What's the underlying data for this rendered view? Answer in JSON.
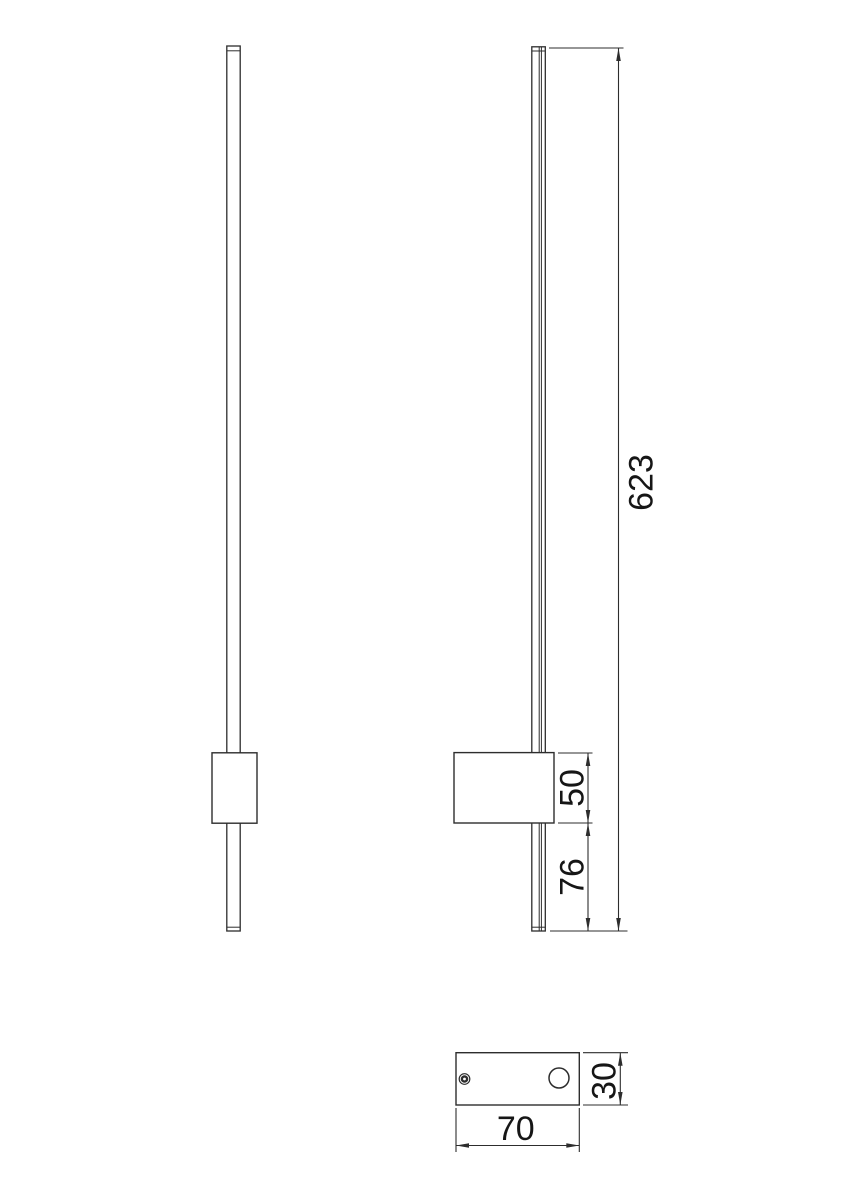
{
  "drawing": {
    "title": "wall-lamp-dimension-drawing",
    "colors": {
      "background": "#ffffff",
      "line": "#2d2d2d",
      "text": "#161616"
    },
    "views": {
      "front": "front-view",
      "side": "side-view",
      "bottom": "base-plate-top-view"
    },
    "dimensions": {
      "total_length": {
        "value": "623",
        "orientation": "vertical"
      },
      "bracket_height": {
        "value": "50",
        "orientation": "vertical"
      },
      "bottom_offset": {
        "value": "76",
        "orientation": "vertical"
      },
      "base_length": {
        "value": "70",
        "orientation": "horizontal"
      },
      "base_depth": {
        "value": "30",
        "orientation": "vertical"
      }
    }
  }
}
